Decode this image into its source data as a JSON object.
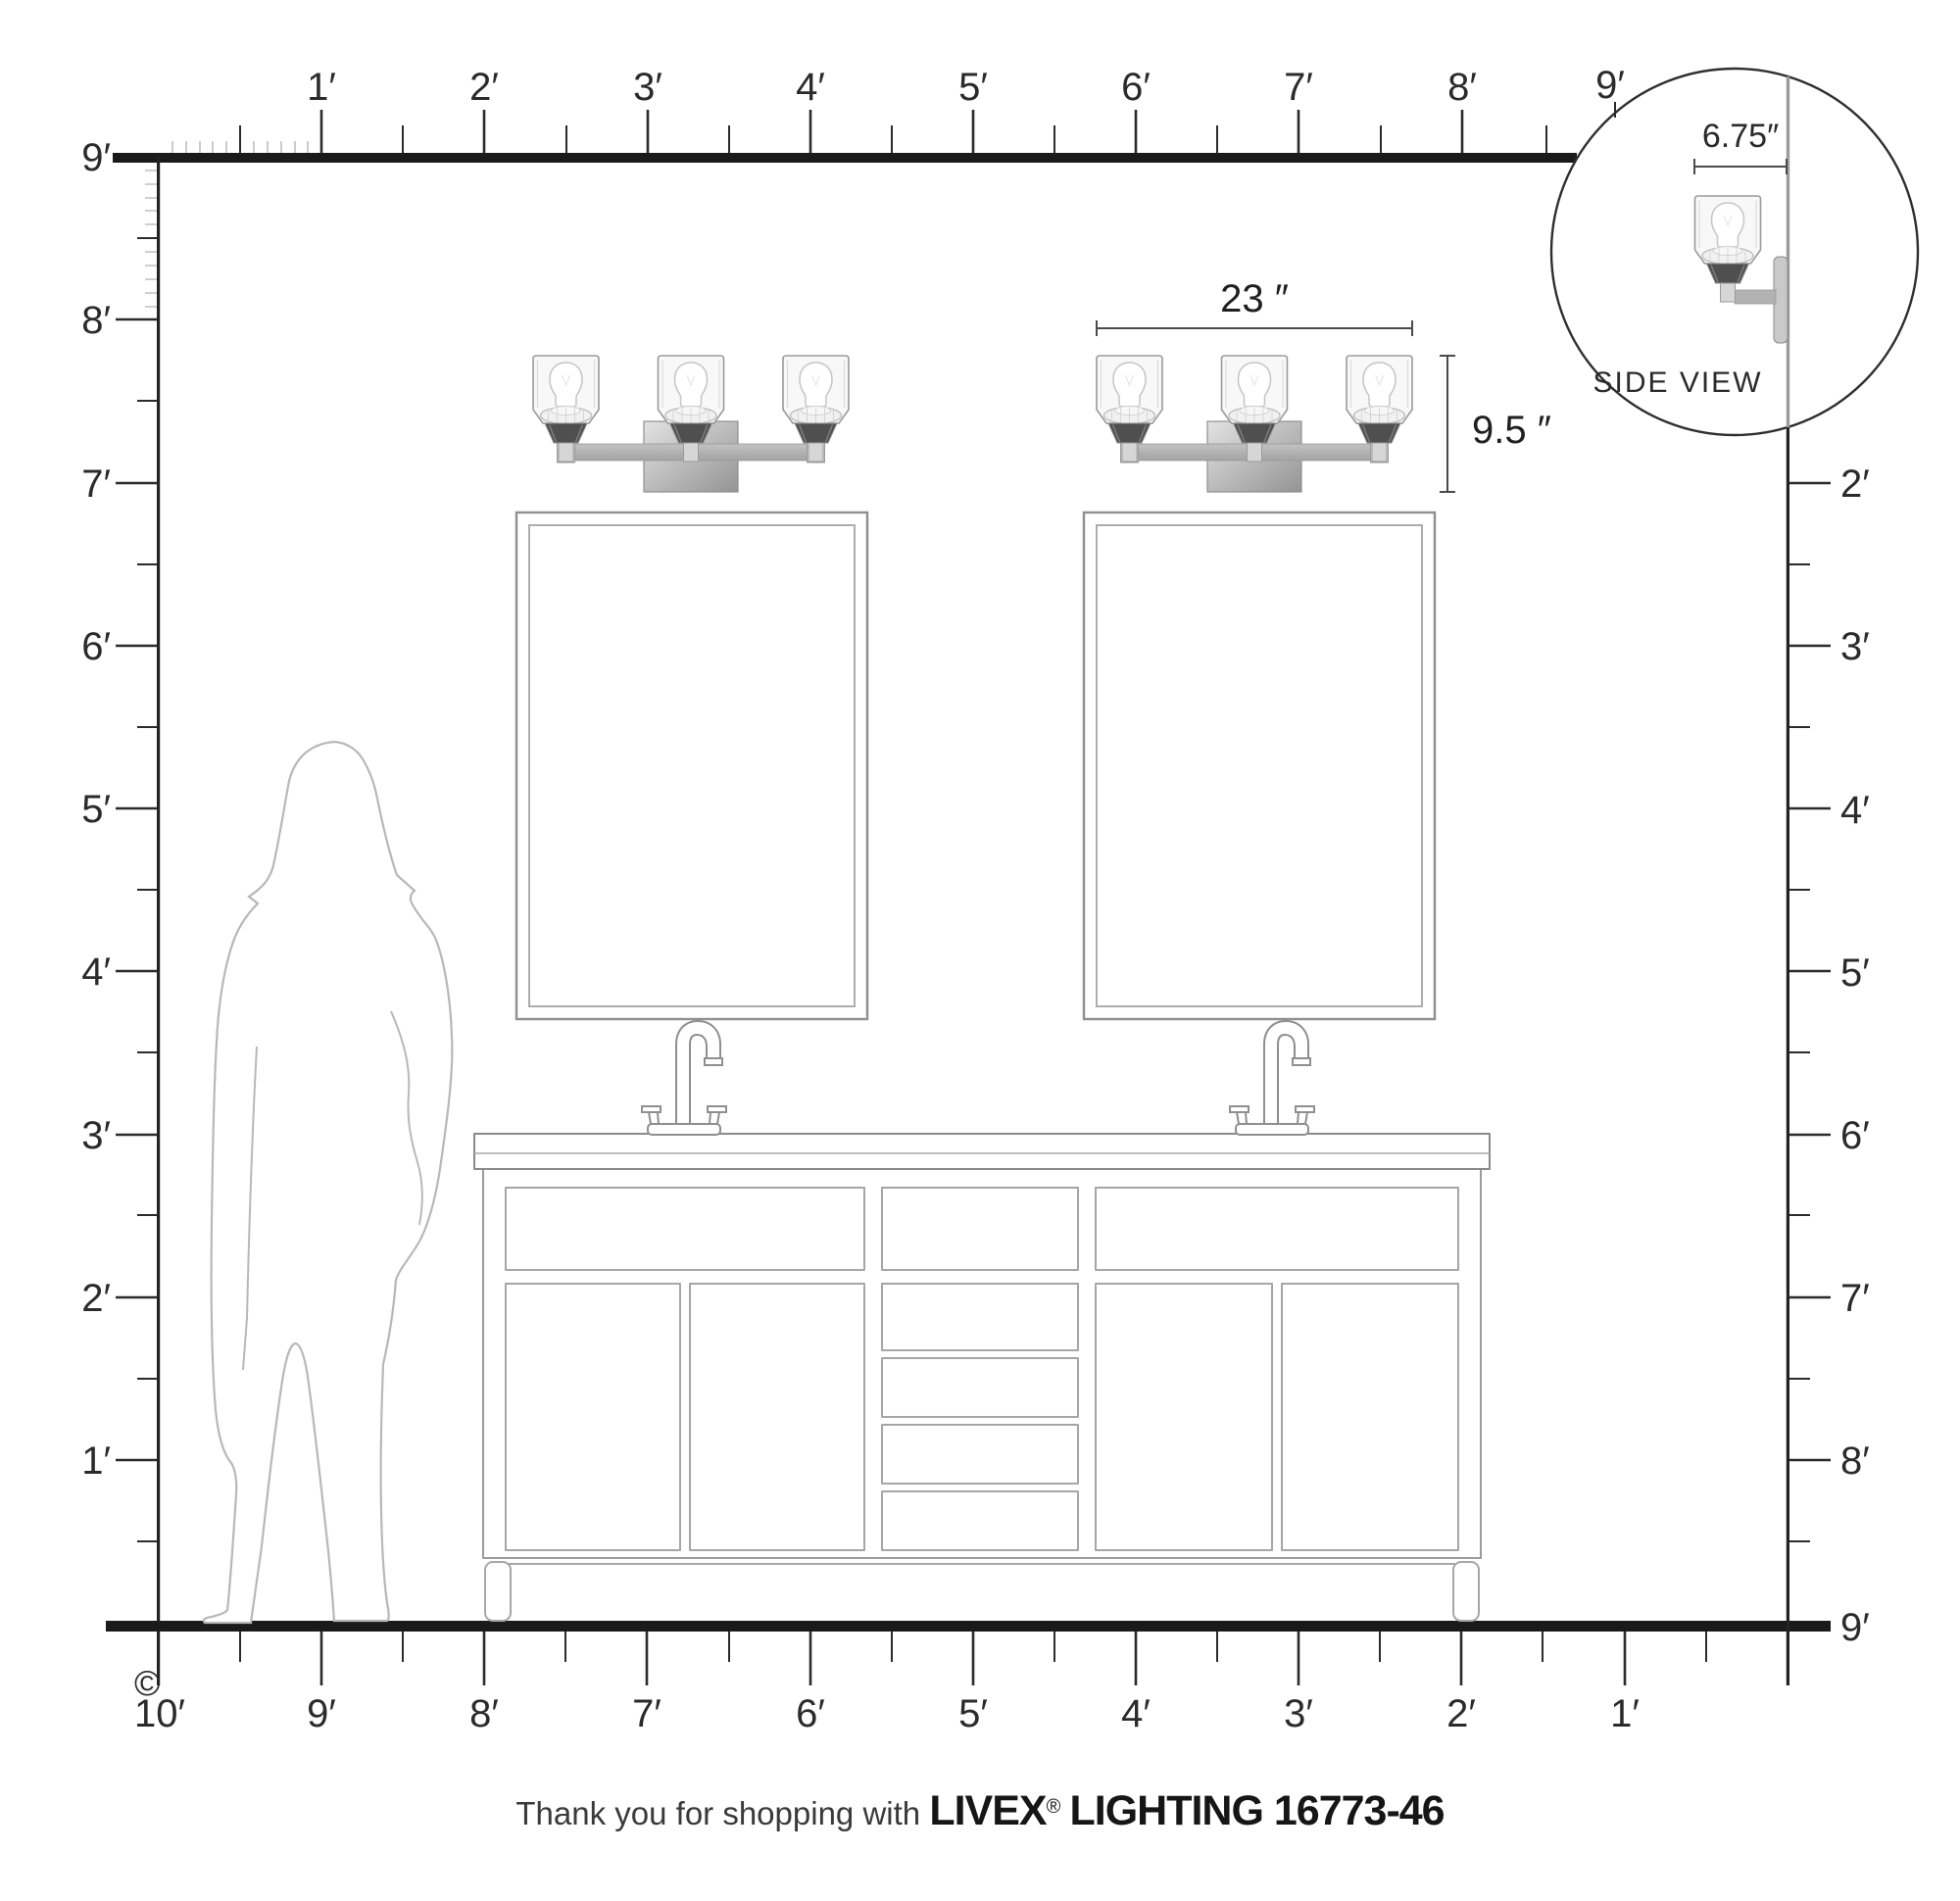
{
  "diagram_title": "Vanity light mounting-scale diagram",
  "rulers": {
    "top": {
      "labels": [
        "1′",
        "2′",
        "3′",
        "4′",
        "5′",
        "6′",
        "7′",
        "8′",
        "9′"
      ]
    },
    "left": {
      "labels": [
        "9′",
        "8′",
        "7′",
        "6′",
        "5′",
        "4′",
        "3′",
        "2′",
        "1′"
      ]
    },
    "right": {
      "labels": [
        "2′",
        "3′",
        "4′",
        "5′",
        "6′",
        "7′",
        "8′",
        "9′"
      ]
    },
    "bottom": {
      "labels": [
        "10′",
        "9′",
        "8′",
        "7′",
        "6′",
        "5′",
        "4′",
        "3′",
        "2′",
        "1′"
      ]
    }
  },
  "dimensions": {
    "fixture_width": "23 ″",
    "fixture_height": "9.5 ″",
    "fixture_depth": "6.75″"
  },
  "side_view": {
    "label": "SIDE VIEW"
  },
  "copyright": "©",
  "footer": {
    "prefix": "Thank you for shopping with",
    "brand": "LIVEX",
    "registered": "®",
    "suffix": "LIGHTING 16773-46"
  },
  "colors": {
    "ruler_line": "#1a1a1a",
    "tick_dark": "#2b2b2b",
    "tick_inch_gray": "#c0c0c0",
    "outline_gray": "#9a9a9a",
    "metal_arm_gray": "#b2b2b2",
    "metal_dark": "#4f4f4f",
    "silhouette_gray": "#b8b8b8"
  }
}
